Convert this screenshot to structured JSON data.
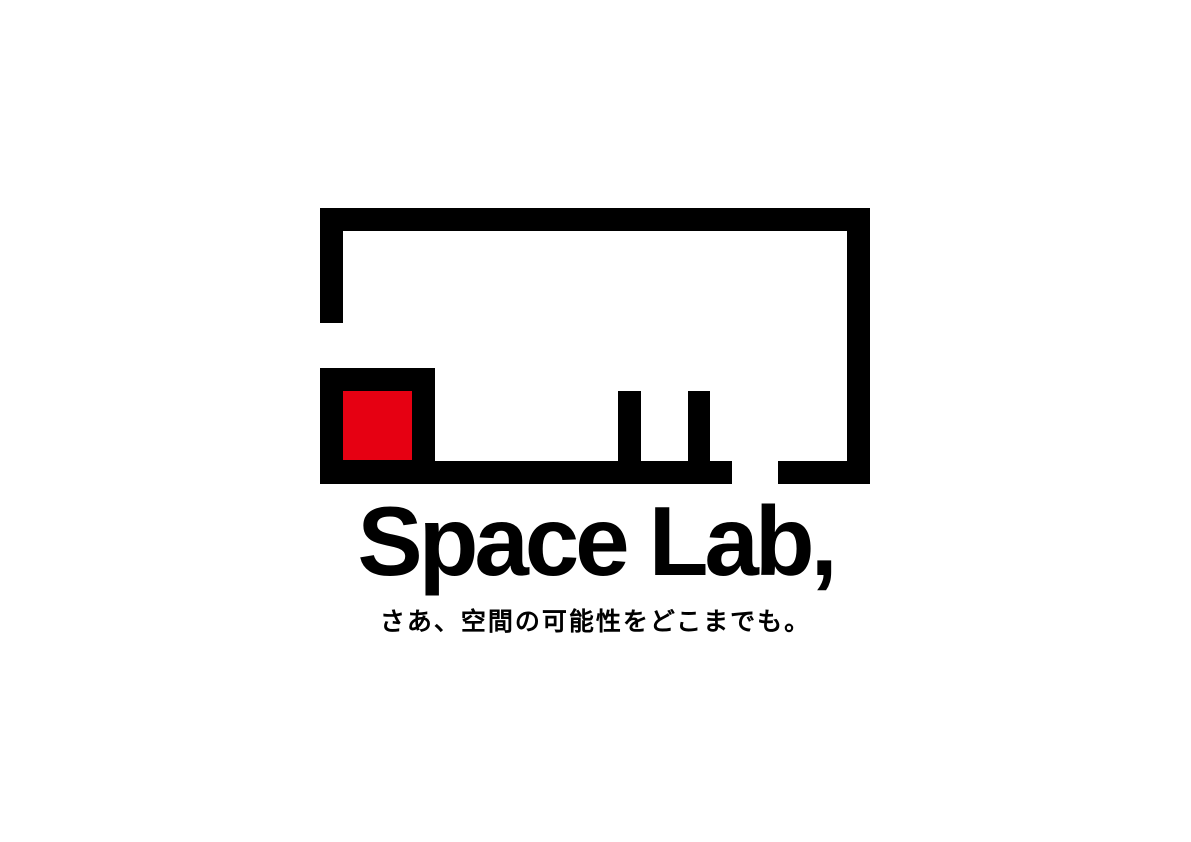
{
  "colors": {
    "background": "#ffffff",
    "ink": "#000000",
    "accent_red": "#e60012"
  },
  "logo": {
    "mark_icon": "room-outline-with-red-square-and-table-legs-icon",
    "wordmark": "Space Lab,",
    "tagline": "さあ、空間の可能性をどこまでも。"
  }
}
